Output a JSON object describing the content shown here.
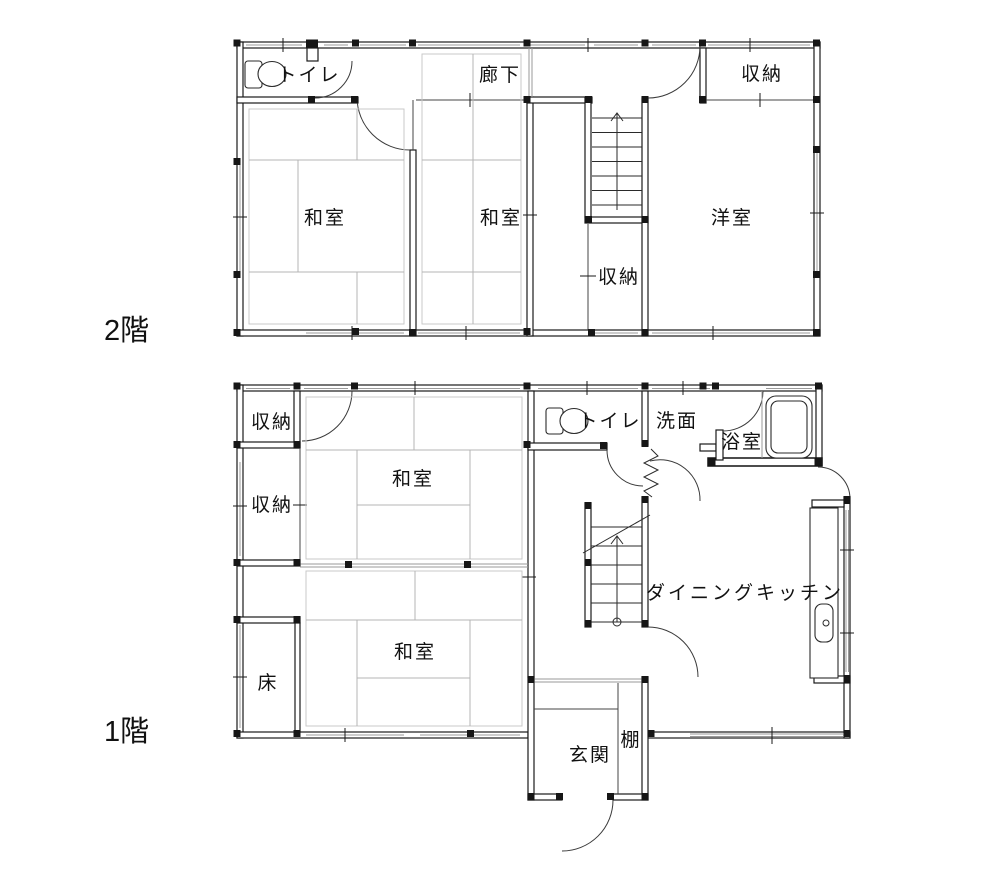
{
  "page": {
    "background": "#ffffff"
  },
  "colors": {
    "wall": "#1a1a1a",
    "tatami_line": "#b4b4b4",
    "window_line": "#9a9a9a",
    "background": "#ffffff"
  },
  "floors": [
    {
      "label": "2階",
      "rooms": {
        "toilet": "トイレ",
        "corridor": "廊下",
        "storage_top_right": "収納",
        "washitsu_left": "和室",
        "washitsu_right": "和室",
        "storage_under_stairs": "収納",
        "western_room": "洋室"
      }
    },
    {
      "label": "1階",
      "rooms": {
        "storage_upper": "収納",
        "storage_lower": "収納",
        "washitsu_top": "和室",
        "toilet": "トイレ",
        "washroom": "洗面",
        "bathroom": "浴室",
        "dining_kitchen": "ダイニングキッチン",
        "washitsu_bottom": "和室",
        "tokonoma": "床",
        "entrance": "玄関",
        "shelf": "棚"
      }
    }
  ]
}
